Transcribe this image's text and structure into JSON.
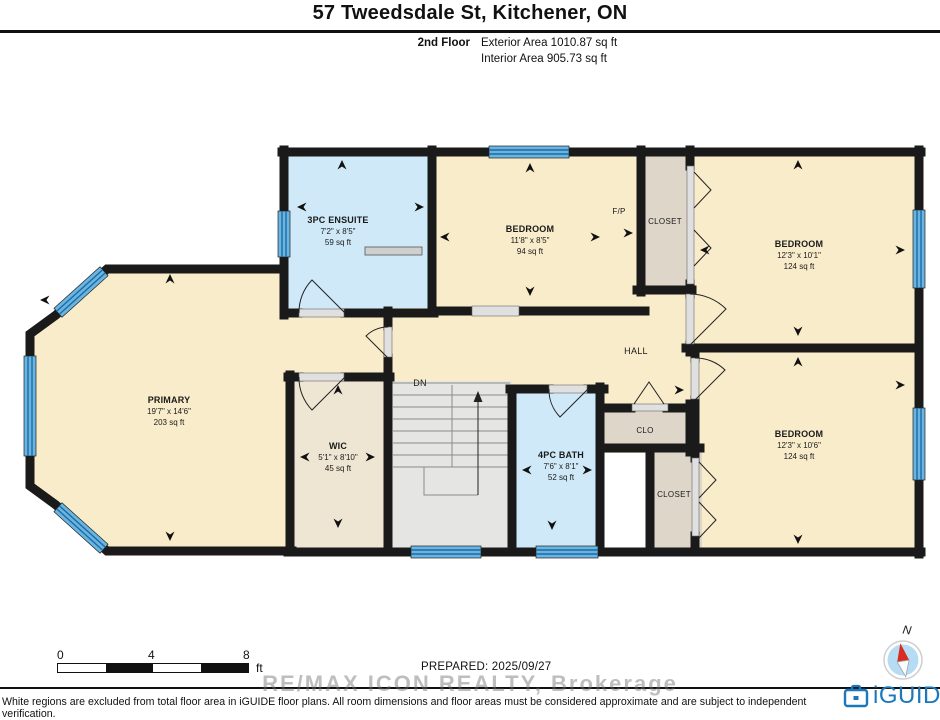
{
  "header": {
    "title": "57 Tweedsdale St, Kitchener, ON",
    "floor_label": "2nd Floor",
    "exterior_area": "Exterior Area 1010.87 sq ft",
    "interior_area": "Interior Area 905.73 sq ft"
  },
  "rooms": {
    "ensuite": {
      "name": "3PC ENSUITE",
      "dims": "7'2\" x 8'5\"",
      "area": "59 sq ft"
    },
    "bedroom_mid": {
      "name": "BEDROOM",
      "dims": "11'8\" x 8'5\"",
      "area": "94 sq ft"
    },
    "bedroom_tr": {
      "name": "BEDROOM",
      "dims": "12'3\" x 10'1\"",
      "area": "124 sq ft"
    },
    "bedroom_br": {
      "name": "BEDROOM",
      "dims": "12'3\" x 10'6\"",
      "area": "124 sq ft"
    },
    "primary": {
      "name": "PRIMARY",
      "dims": "19'7\" x 14'6\"",
      "area": "203 sq ft"
    },
    "wic": {
      "name": "WIC",
      "dims": "5'1\" x 8'10\"",
      "area": "45 sq ft"
    },
    "bath": {
      "name": "4PC BATH",
      "dims": "7'6\" x 8'1\"",
      "area": "52 sq ft"
    },
    "hall": "HALL",
    "clo": "CLO",
    "closet_top": "CLOSET",
    "closet_bottom": "CLOSET",
    "fireplace": "F/P",
    "down": "DN"
  },
  "footer": {
    "scale": {
      "tick0": "0",
      "tick4": "4",
      "tick8": "8",
      "unit": "ft"
    },
    "prepared": "PREPARED: 2025/09/27",
    "watermark": "RE/MAX ICON REALTY, Brokerage",
    "disclaimer": "White regions are excluded from total floor area in iGUIDE floor plans. All room dimensions and floor areas must be considered approximate and are subject to independent verification.",
    "brand": "iGUIDE",
    "compass_label": "N"
  },
  "colors": {
    "room_beige": "#f8ecca",
    "room_blue": "#cfe9f8",
    "stairs_gray": "#e5e5e3",
    "closet_tan": "#ded6c9",
    "wic_tan": "#efe5d3",
    "window_blue": "#69b4e1",
    "window_line": "#1c6ba3",
    "wall": "#1a1a1a",
    "brand_blue": "#1b78bd",
    "compass_red": "#d82c20"
  }
}
